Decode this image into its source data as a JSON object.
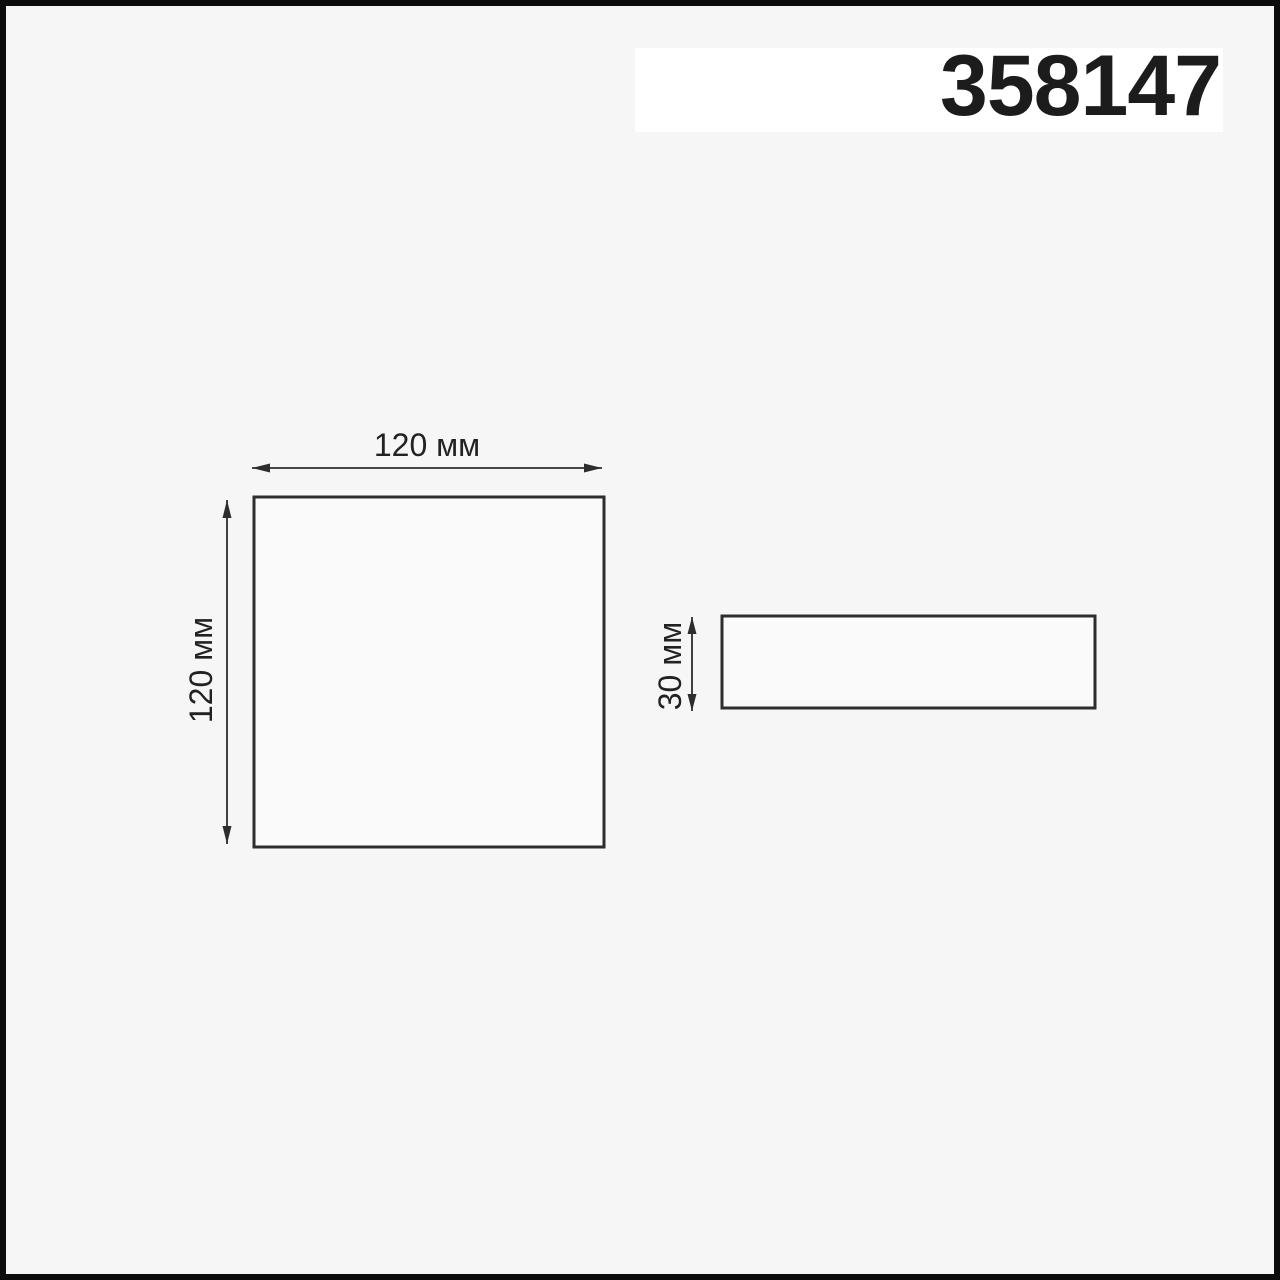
{
  "header": {
    "product_code": "358147"
  },
  "colors": {
    "page_background": "#f6f6f6",
    "banner_background": "#ffffff",
    "frame_border": "#0c0c0c",
    "line": "#2d2d2d",
    "text": "#1c1c1c"
  },
  "diagram": {
    "front_view": {
      "width_label": "120 мм",
      "height_label": "120 мм"
    },
    "side_view": {
      "height_label": "30 мм"
    }
  }
}
